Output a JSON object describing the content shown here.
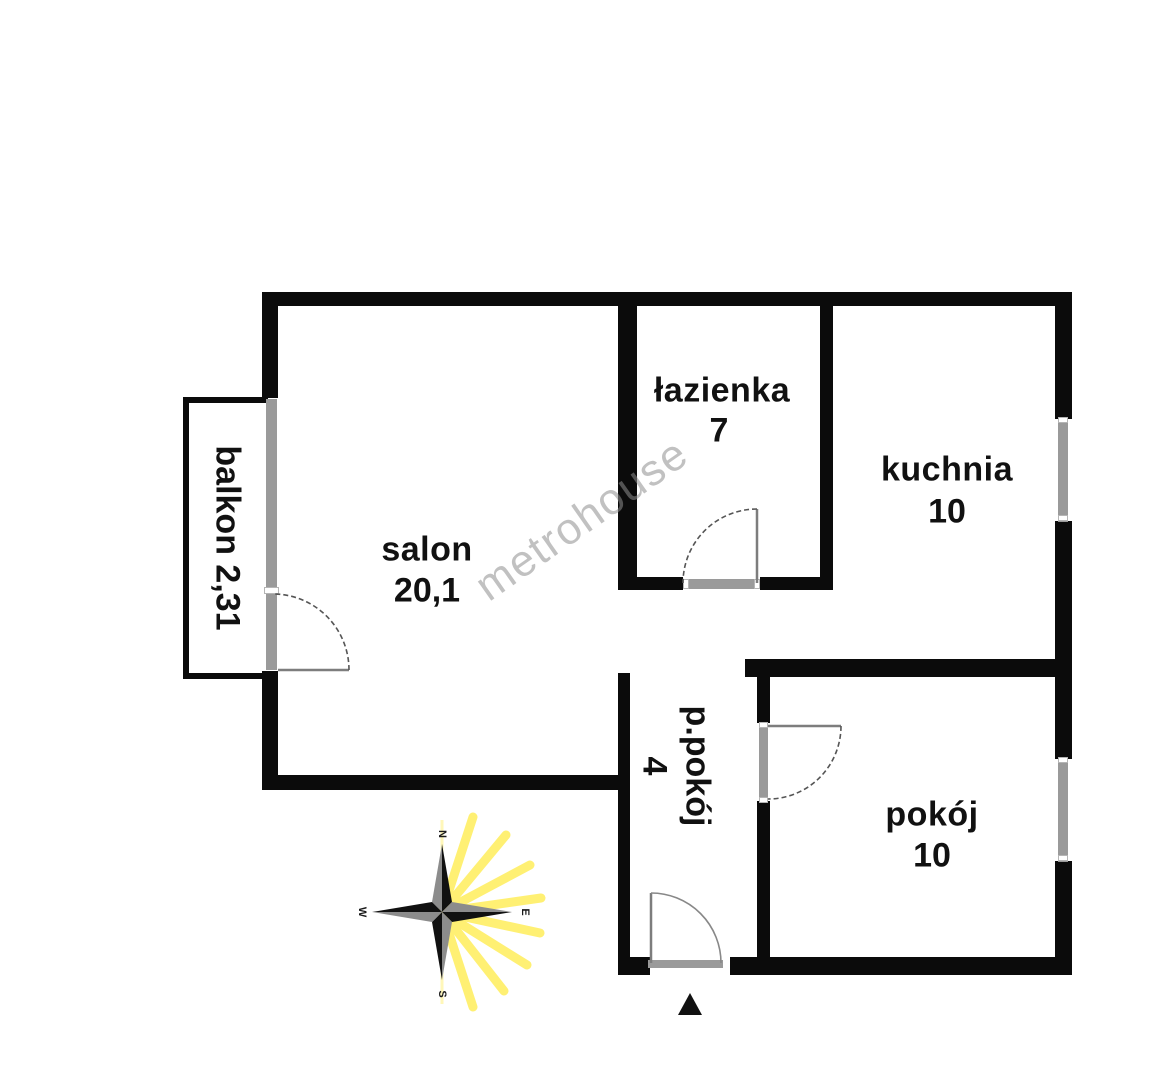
{
  "plan": {
    "watermark": "metrohouse",
    "rooms": [
      {
        "id": "salon",
        "label": "salon",
        "area": "20,1"
      },
      {
        "id": "lazienka",
        "label": "łazienka",
        "area": "7"
      },
      {
        "id": "kuchnia",
        "label": "kuchnia",
        "area": "10"
      },
      {
        "id": "ppokoj",
        "label": "p.pokój",
        "area": "4"
      },
      {
        "id": "pokoj",
        "label": "pokój",
        "area": "10"
      },
      {
        "id": "balkon",
        "label": "balkon",
        "area": "2,31"
      }
    ],
    "compass": {
      "north": "N",
      "east": "E",
      "south": "S",
      "west": "W"
    },
    "colors": {
      "wall": "#0b0b0b",
      "window": "#9a9a9a",
      "sun_ray": "#ffe81f",
      "watermark": "#8f8f8f"
    }
  }
}
